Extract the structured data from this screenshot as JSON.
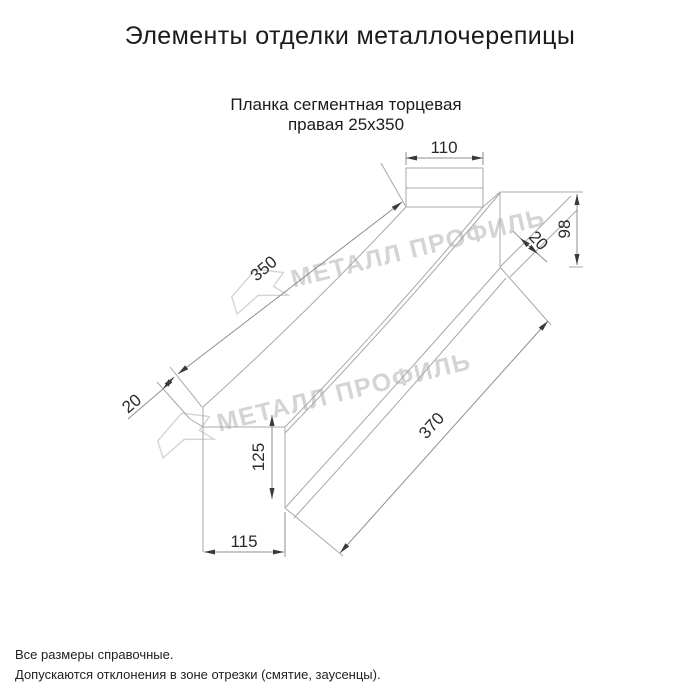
{
  "page": {
    "title": "Элементы отделки металлочерепицы",
    "subtitle_line1": "Планка сегментная торцевая",
    "subtitle_line2": "правая 25х350",
    "footer_line1": "Все размеры справочные.",
    "footer_line2": "Допускаются отклонения в зоне отрезки (смятие, заусенцы)."
  },
  "watermark": {
    "text": "МЕТАЛЛ ПРОФИЛЬ",
    "color": "#d4d4d4",
    "logo": "metall-profil-arrow-logo"
  },
  "drawing": {
    "part_name": "Планка сегментная торцевая правая",
    "size": "25х350",
    "line_color": "#a8a8a8",
    "text_color": "#2a2a2a",
    "dims": {
      "top_width": "110",
      "top_face_length": "350",
      "hem_top": "20",
      "end_height": "98",
      "hem_bottom": "20",
      "side_height": "125",
      "side_face_length": "370",
      "bottom_width": "115"
    }
  }
}
